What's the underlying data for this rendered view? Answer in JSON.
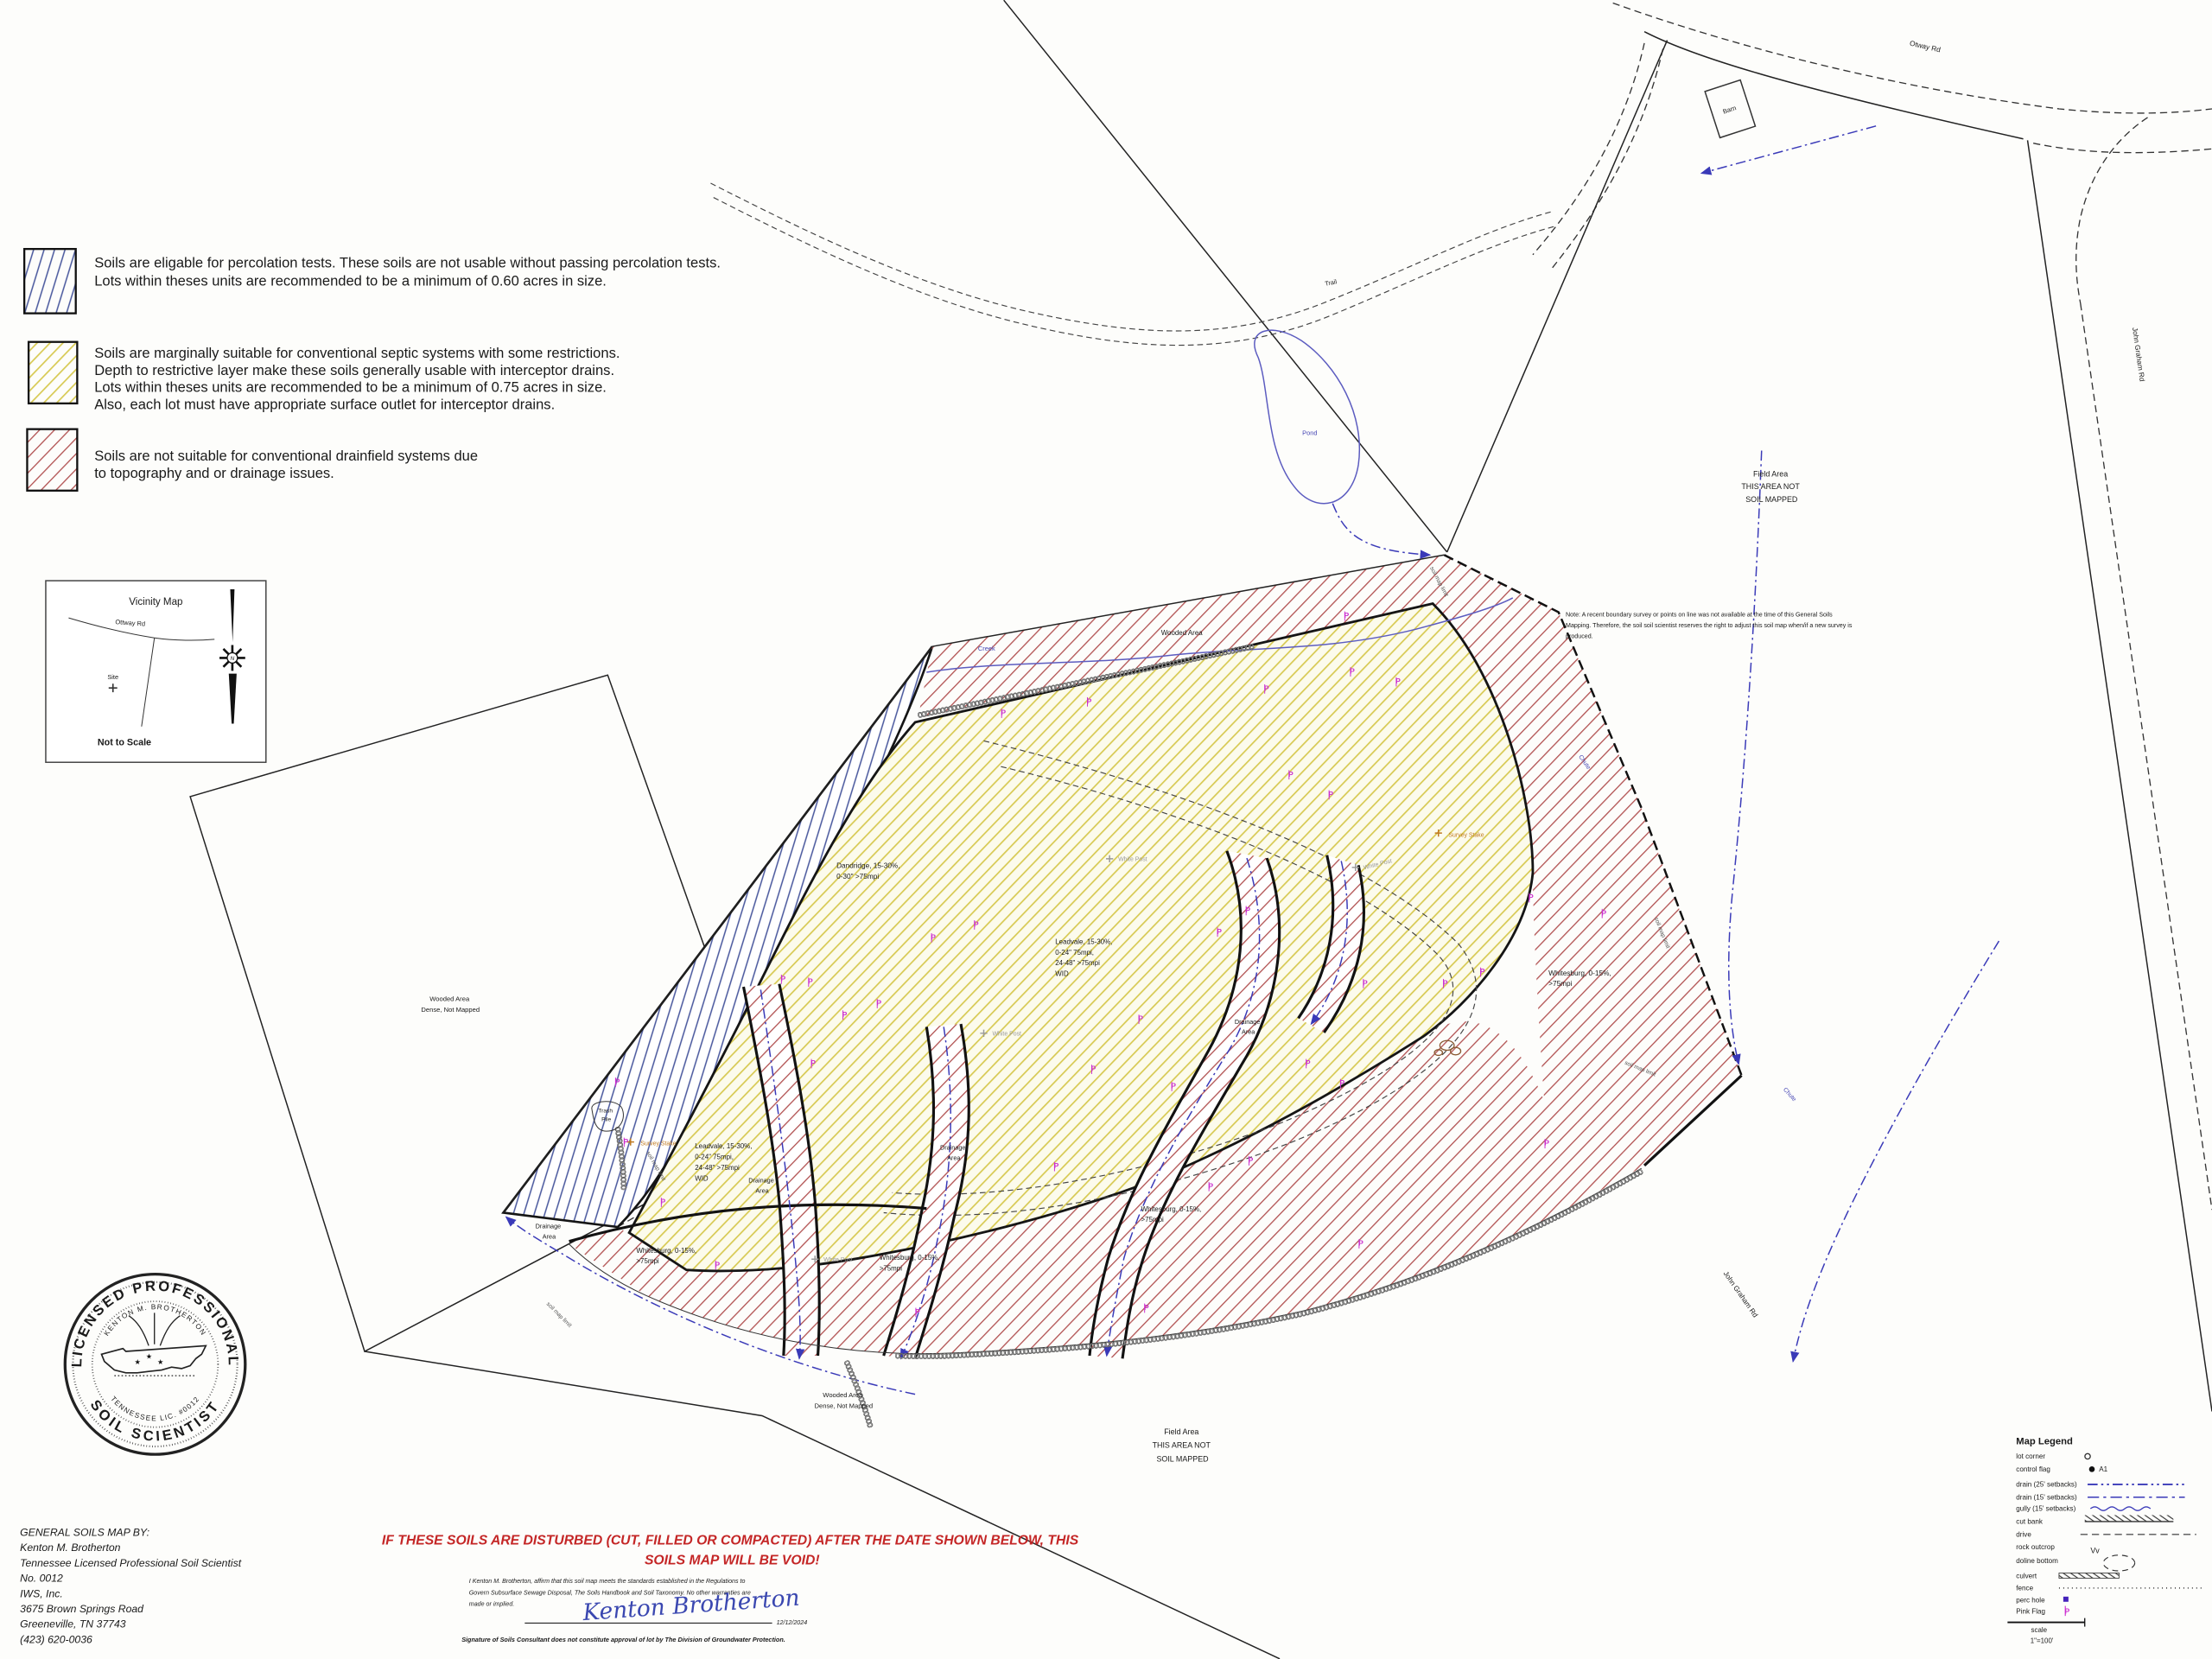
{
  "colors": {
    "blue_hatch": "#45549b",
    "yellow_hatch": "#d6c84e",
    "red_hatch": "#b25353",
    "pink_flag": "#cc2fd0",
    "drain_blue": "#3a3ab8",
    "warning_red": "#c42626",
    "signature_blue": "#3a47b0",
    "survey_stake_orange": "#c07a20",
    "white_post_gray": "#9a9a9a"
  },
  "soil_legend": {
    "items": [
      {
        "swatch": "blue-diagonal-hatch",
        "lines": [
          "Soils are eligable for percolation tests. These soils are not usable without passing percolation tests.",
          "Lots within theses units are recommended to be a minimum of 0.60 acres in size."
        ]
      },
      {
        "swatch": "yellow-diagonal-hatch",
        "lines": [
          "Soils are marginally suitable for conventional septic systems with some restrictions.",
          " Depth to restrictive layer make these soils generally usable with interceptor drains.",
          "Lots within theses units are recommended to be a minimum of 0.75 acres in size.",
          "Also, each lot must have appropriate surface outlet for interceptor drains."
        ]
      },
      {
        "swatch": "red-diagonal-hatch",
        "lines": [
          "Soils are not suitable for conventional drainfield systems due",
          "to topography and or drainage issues."
        ]
      }
    ]
  },
  "vicinity": {
    "title": "Vicinity Map",
    "ottway_rd": "Ottway Rd",
    "site": "Site",
    "john_graham_rd": "John Graham Rd",
    "scale_note": "Not to Scale",
    "north": "N"
  },
  "map": {
    "pink_flag_glyph": "P",
    "labels": {
      "barn": "Barn",
      "otway_rd": "Otway Rd",
      "john_graham_rd": "John Graham Rd",
      "trail": "Trail",
      "pond": "Pond",
      "creek": "Creek",
      "wooded_area": "Wooded Area",
      "field_area": [
        "Field Area",
        "THIS AREA NOT",
        "SOIL MAPPED"
      ],
      "note": [
        "Note: A recent boundary survey or points on line was not available at the time of this General Soils",
        "Mapping. Therefore, the soil soil scientist reserves the right to adjust this soil map when/if a new survey is",
        "produced."
      ],
      "dandridge": [
        "Dandridge, 15-30%,",
        "0-30\" >75mpi"
      ],
      "leadvale": [
        "Leadvale, 15-30%,",
        "0-24\" 75mpi,",
        "24-48\" >75mpi",
        "WID"
      ],
      "whitesburg": [
        "Whitesburg, 0-15%,",
        ">75mpi"
      ],
      "drainage_area": [
        "Drainage",
        "Area"
      ],
      "wooded_dense": [
        "Wooded Area",
        "Dense, Not Mapped"
      ],
      "white_post": "White Post",
      "survey_stake": "Survey Stake",
      "trash_pile": [
        "Trash",
        "Pile"
      ],
      "soil_map_limit": "soil map limit",
      "chute": "Chute"
    }
  },
  "seal": {
    "ring_top": "LICENSED PROFESSIONAL",
    "ring_bottom": "SOIL SCIENTIST",
    "inner_top": "KENTON M. BROTHERTON",
    "inner_bottom": "TENNESSEE LIC. #0012"
  },
  "credits": {
    "lines": [
      "GENERAL SOILS MAP BY:",
      "Kenton M. Brotherton",
      "Tennessee Licensed Professional Soil Scientist",
      "No. 0012",
      "IWS, Inc.",
      "3675 Brown Springs Road",
      "Greeneville, TN 37743",
      "(423) 620-0036"
    ]
  },
  "warning": {
    "lines": [
      "IF THESE SOILS ARE DISTURBED (CUT, FILLED OR COMPACTED) AFTER THE DATE SHOWN BELOW, THIS",
      "SOILS MAP WILL BE VOID!"
    ]
  },
  "affirmation": {
    "lines": [
      "I Kenton M. Brotherton, affirm that this soil map meets the standards established in the Regulations to",
      "Govern Subsurface Sewage Disposal, The Soils Handbook and Soil Taxonomy.  No other warranties are",
      "made or implied."
    ]
  },
  "signature": {
    "name": "Kenton Brotherton",
    "date": "12/12/2024"
  },
  "disclaimer": "Signature of Soils Consultant does not constitute approval of lot by The Division of Groundwater Protection.",
  "map_legend": {
    "title": "Map Legend",
    "rows": [
      {
        "label": "lot corner",
        "symbol": "circle-outline"
      },
      {
        "label": "control flag",
        "symbol": "filled-dot",
        "extra": "A1"
      },
      {
        "label": "drain (25' setbacks)",
        "symbol": "blue-dash-dot-line"
      },
      {
        "label": "drain (15' setbacks)",
        "symbol": "blue-dashed-line"
      },
      {
        "label": "gully  (15' setbacks)",
        "symbol": "blue-wavy-line"
      },
      {
        "label": "cut bank",
        "symbol": "hatched-bar"
      },
      {
        "label": "drive",
        "symbol": "gray-dashed-line"
      },
      {
        "label": "rock outcrop",
        "symbol": "glyph",
        "glyph": "Vv"
      },
      {
        "label": "doline bottom",
        "symbol": "dashed-ellipse"
      },
      {
        "label": "culvert",
        "symbol": "chain-bar"
      },
      {
        "label": "fence",
        "symbol": "dotted-line"
      },
      {
        "label": "perc hole",
        "symbol": "purple-square"
      },
      {
        "label": "Pink Flag",
        "symbol": "pink-flag"
      }
    ],
    "scale_label": "scale",
    "scale_value": "1\"=100'"
  }
}
